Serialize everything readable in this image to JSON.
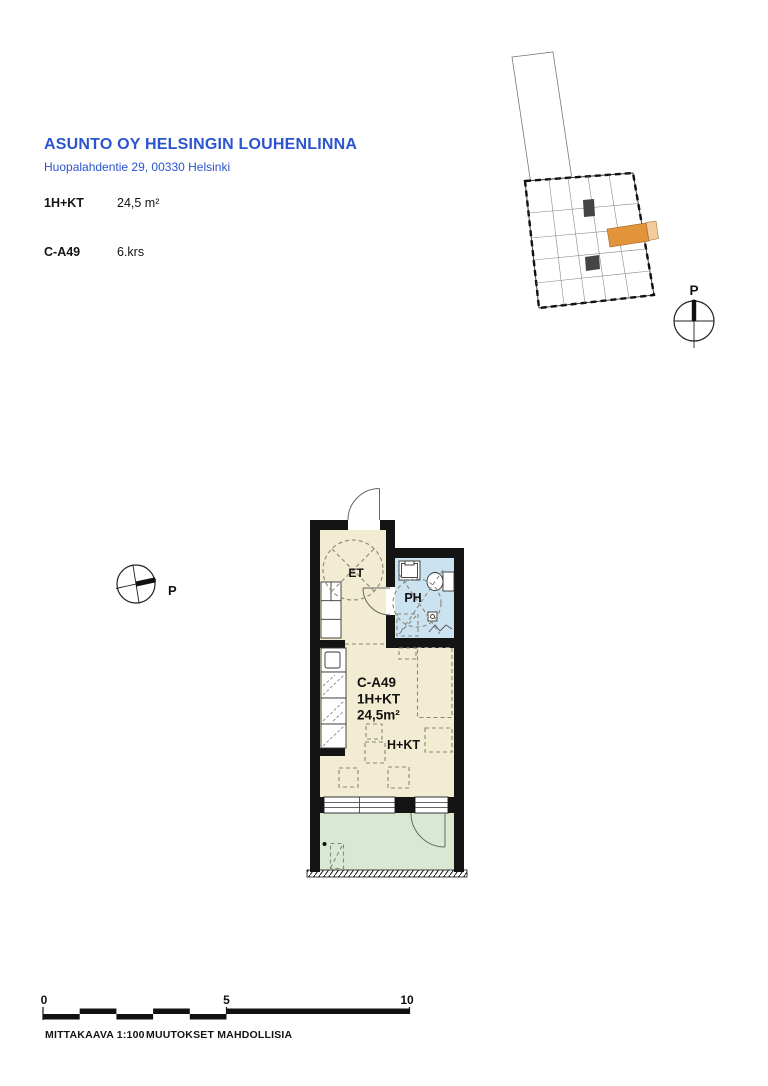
{
  "document": {
    "title": "ASUNTO OY HELSINGIN LOUHENLINNA",
    "address": "Huopalahdentie 29, 00330 Helsinki",
    "specs": [
      {
        "label": "1H+KT",
        "value": "24,5 m²"
      },
      {
        "label": "C-A49",
        "value": "6.krs"
      }
    ]
  },
  "floor_plan": {
    "room_labels": {
      "entry": "ET",
      "bathroom": "PH",
      "living_kitchen": "H+KT"
    },
    "unit_stamp": {
      "id": "C-A49",
      "type": "1H+KT",
      "area": "24,5m²"
    }
  },
  "key_plan": {
    "north_label": "P"
  },
  "site_compass": {
    "north_label": "P"
  },
  "scale_bar": {
    "ticks": [
      "0",
      "5",
      "10"
    ],
    "scale_label": "MITTAKAAVA 1:100",
    "note_label": "MUUTOKSET MAHDOLLISIA"
  },
  "colors": {
    "accent_blue": "#2b54cf",
    "floor_beige": "#f1ecd2",
    "bath_blue": "#cbe3f1",
    "balcony_green": "#d9e8d3",
    "unit_highlight_orange": "#e2943b",
    "wall_black": "#141414"
  }
}
